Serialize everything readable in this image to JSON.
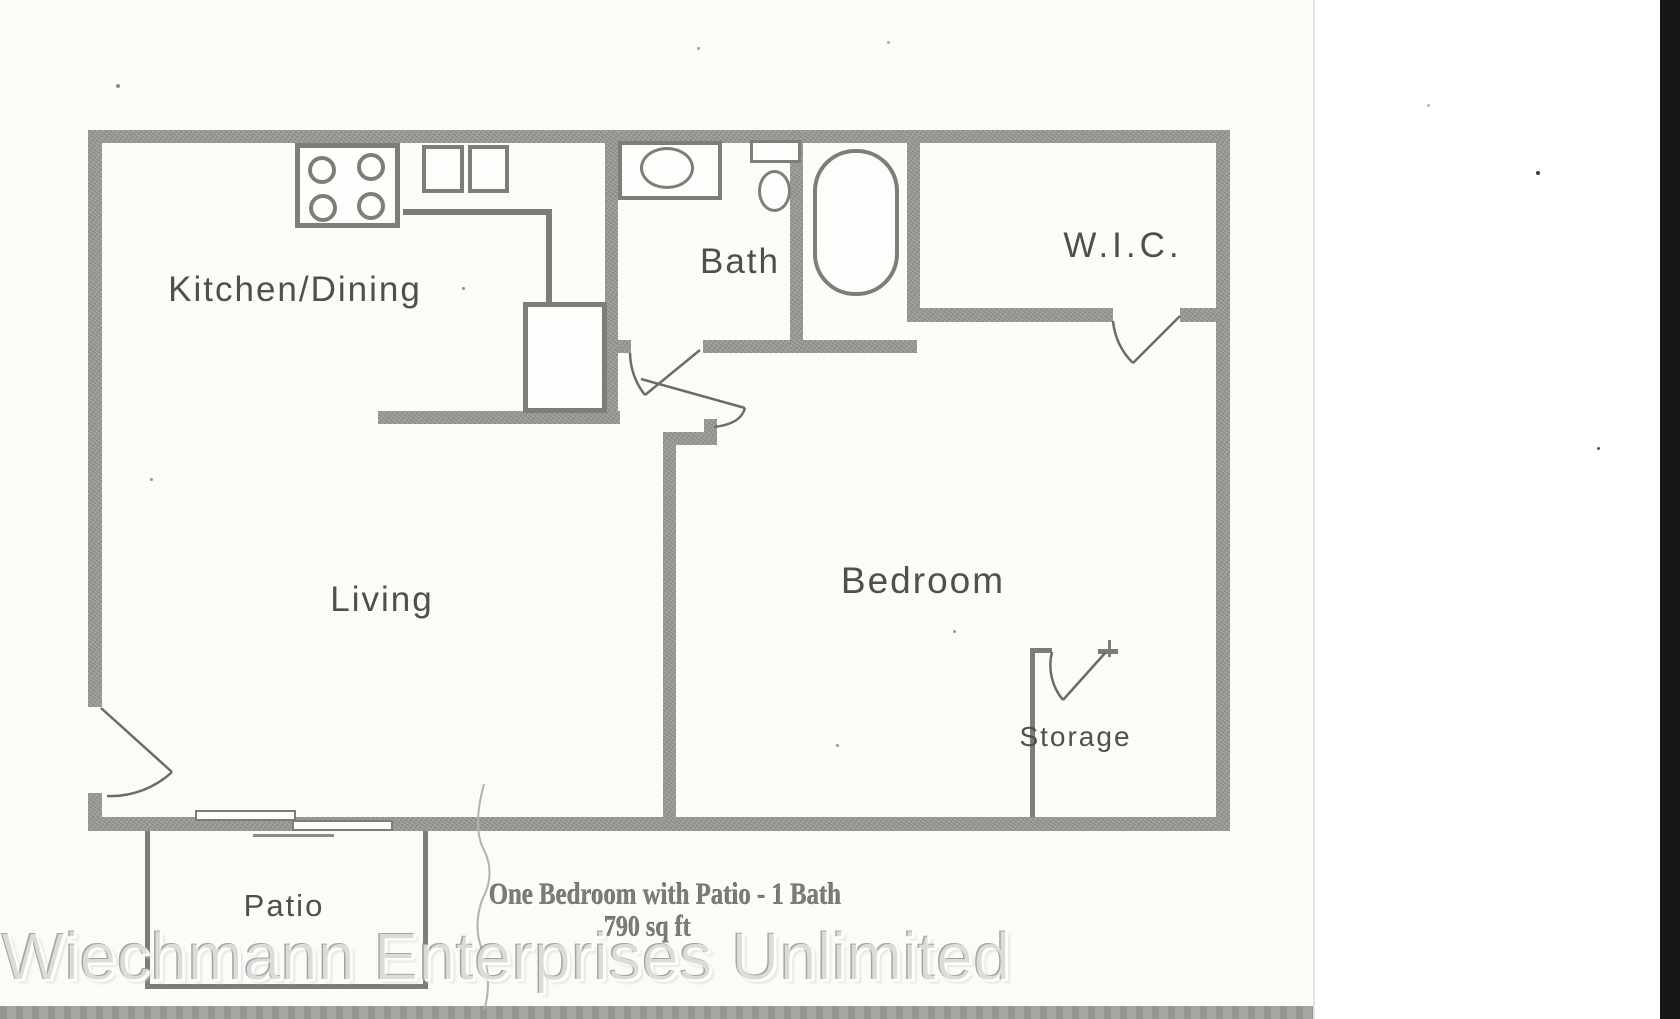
{
  "rooms": {
    "kitchen_dining": "Kitchen/Dining",
    "bath": "Bath",
    "wic": "W.I.C.",
    "living": "Living",
    "bedroom": "Bedroom",
    "storage": "Storage",
    "patio": "Patio"
  },
  "caption": {
    "line1": "One Bedroom with Patio - 1 Bath",
    "line2": "790 sq ft"
  },
  "watermark_text": "Wiechmann Enterprises Unlimited",
  "colors": {
    "wall": "#94958e",
    "page": "#fbfbf8",
    "scan_bar": "#a6a8a2",
    "edge_black": "#161616"
  }
}
